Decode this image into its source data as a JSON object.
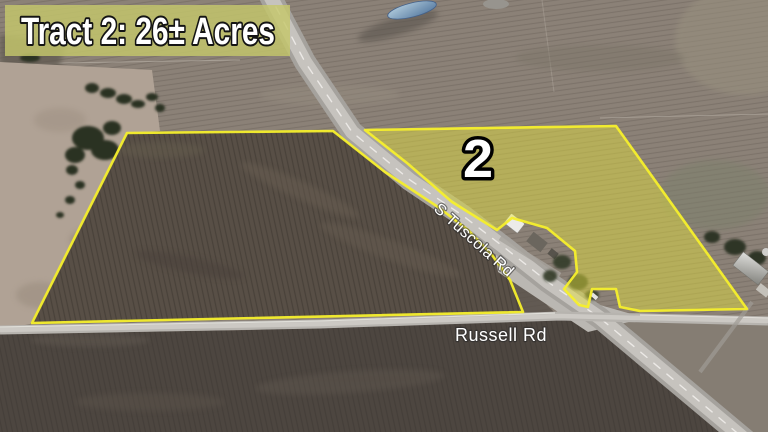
{
  "banner": {
    "title": "Tract 2: 26± Acres"
  },
  "tract_marker": "2",
  "road_labels": {
    "diagonal_road": "S Tuscola Rd",
    "horizontal_road": "Russell Rd"
  },
  "colors": {
    "boundary_yellow": "#f5ef2c",
    "tract_fill_yellow": "#e9e43a",
    "banner_fill_olive": "#c5c76b",
    "label_white": "#ffffff",
    "marker_outline_black": "#000000"
  }
}
